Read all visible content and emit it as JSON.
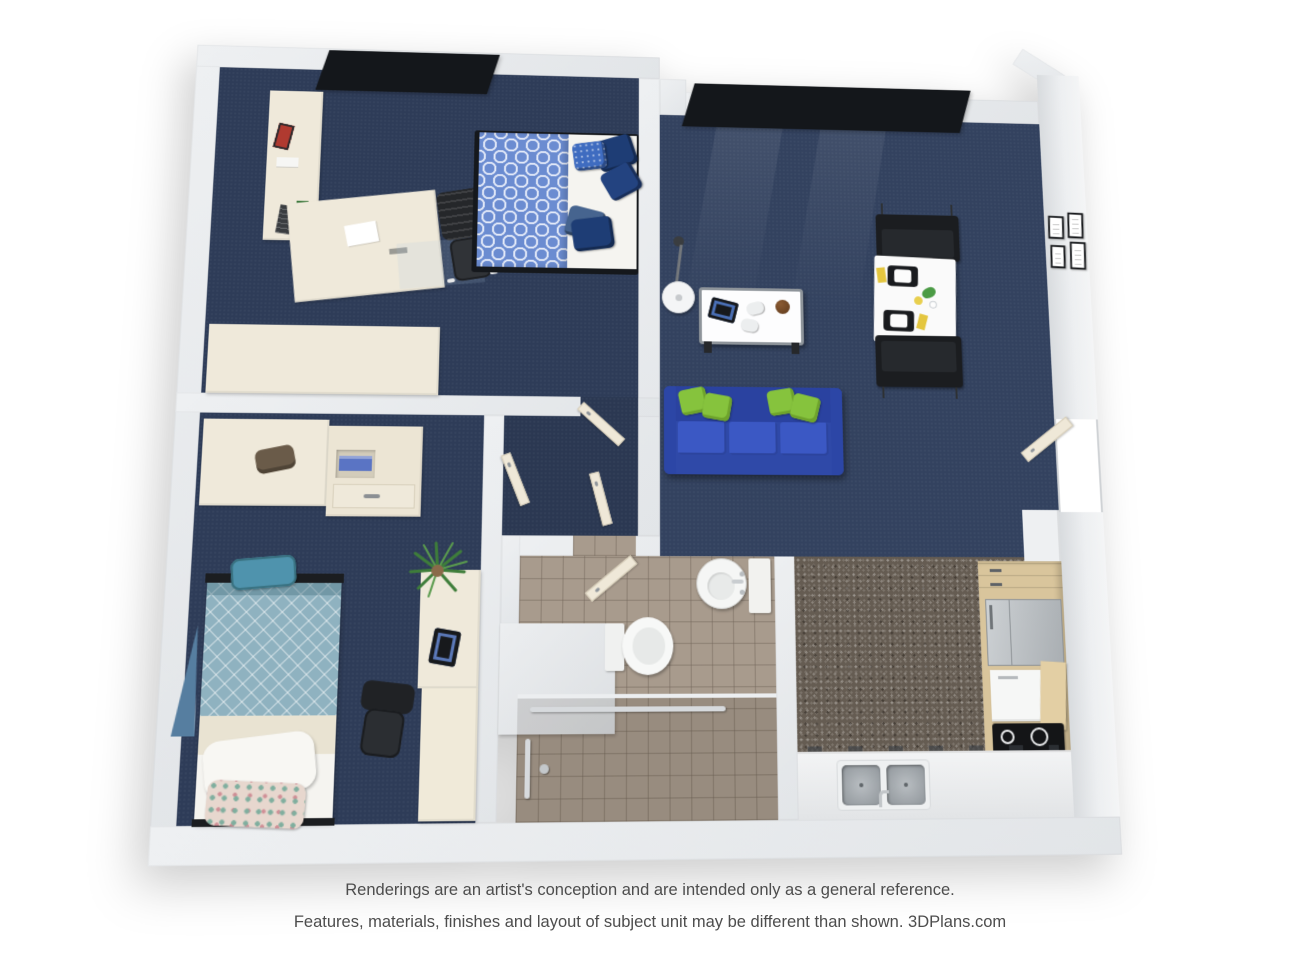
{
  "disclaimer": {
    "line1": "Renderings are an artist's conception and are intended only as a general reference.",
    "line2": "Features, materials, finishes and layout of subject unit may be different than shown. 3DPlans.com",
    "brand": "3DPlans.com"
  },
  "palette": {
    "background": "#ffffff",
    "wall_gray": "#e8eaed",
    "carpet_navy": "#2e3c58",
    "carpet_living": "#33425f",
    "sofa_blue": "#2f49a8",
    "throw_pillow_green": "#86c33d",
    "bed1_duvet_blue": "#6b8cd1",
    "bed1_pillow_navy": "#1e3d75",
    "bed2_duvet_teal": "#8fb2c0",
    "furniture_cream": "#efe9da",
    "bathroom_tile_taupe": "#a89b8d",
    "kitchen_floor_speckle": "#655c52",
    "wood_cabinet": "#d9c59c",
    "appliance_steel": "#b9bec2",
    "cooktop_black": "#141517",
    "window_frame_black": "#14171b",
    "accent_yellow": "#e4c63f"
  },
  "floor_plan": {
    "view": "3d-top-down-rendering",
    "rooms": [
      {
        "name": "bedroom-1",
        "floor": "navy-carpet",
        "furniture": [
          "window-2-pane",
          "bookcase-with-books",
          "desk",
          "office-chair",
          "chair-mat",
          "double-bed-blue-pattern-duvet",
          "accent-pillows",
          "wardrobe-closet-block"
        ]
      },
      {
        "name": "living-dining-room",
        "floor": "navy-carpet",
        "furniture": [
          "window-3-pane",
          "floor-lamp",
          "coffee-table",
          "tablet",
          "game-controllers",
          "basketball",
          "blue-sofa",
          "green-throw-pillows",
          "dining-table",
          "place-settings",
          "dining-chairs",
          "wall-art-4-frames",
          "entry-door"
        ]
      },
      {
        "name": "bedroom-2",
        "floor": "navy-carpet",
        "furniture": [
          "wardrobe-closet",
          "dresser-open-shelves",
          "duffel-bag",
          "single-bed-teal-diamond-duvet",
          "white-pillow",
          "floral-pillow",
          "teal-bag",
          "desk-hutch",
          "office-chair",
          "tablet",
          "potted-plant",
          "blue-triangle-decor"
        ]
      },
      {
        "name": "hallway",
        "floor": "navy-carpet",
        "furniture": [
          "bedroom-1-door",
          "bedroom-2-door",
          "closet-door",
          "bathroom-door"
        ]
      },
      {
        "name": "bathroom",
        "floor": "taupe-tile",
        "furniture": [
          "round-pedestal-sink",
          "side-cabinet",
          "toilet",
          "vanity-block",
          "roll-in-shower",
          "grab-bars"
        ]
      },
      {
        "name": "kitchen",
        "floor": "speckled-vinyl",
        "furniture": [
          "wood-cabinets",
          "refrigerator",
          "white-appliance",
          "wood-panel",
          "cooktop-4-burner",
          "base-counter",
          "double-sink",
          "faucet"
        ]
      }
    ]
  }
}
